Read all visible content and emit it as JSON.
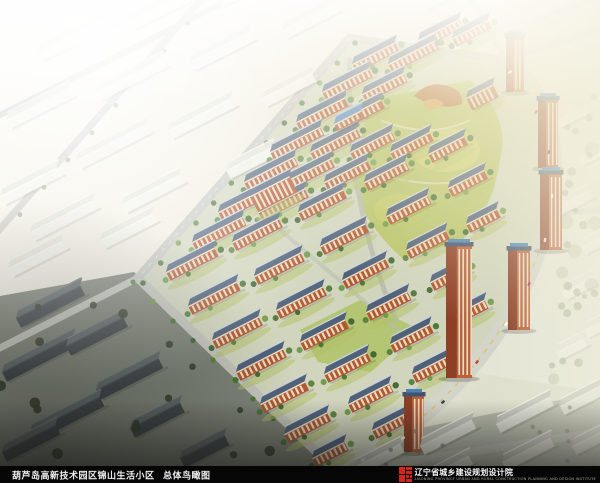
{
  "caption": {
    "project_title": "葫芦岛高新技术园区锦山生活小区",
    "drawing_title": "总体鸟瞰图"
  },
  "logo": {
    "institute_name": "辽宁省城乡建设规划设计院",
    "institute_subtitle": "LIAONING PROVINCE URBAN AND RURAL CONSTRUCTION PLANNING AND DESIGN INSTITUTE"
  },
  "palette": {
    "caption_bar_bg": "#060606",
    "caption_text": "#ededed",
    "logo_red": "#d3251b",
    "complex_roof": "#50627a",
    "complex_brick": "#b0582f",
    "tree_green": "#54793a",
    "lawn_green": "#b2c163",
    "road_gray": "#c9cac1",
    "lane_yellow": "#e2bd4c",
    "haze_white": "#fbfaf2",
    "haze_cream": "#f7f0d8"
  }
}
